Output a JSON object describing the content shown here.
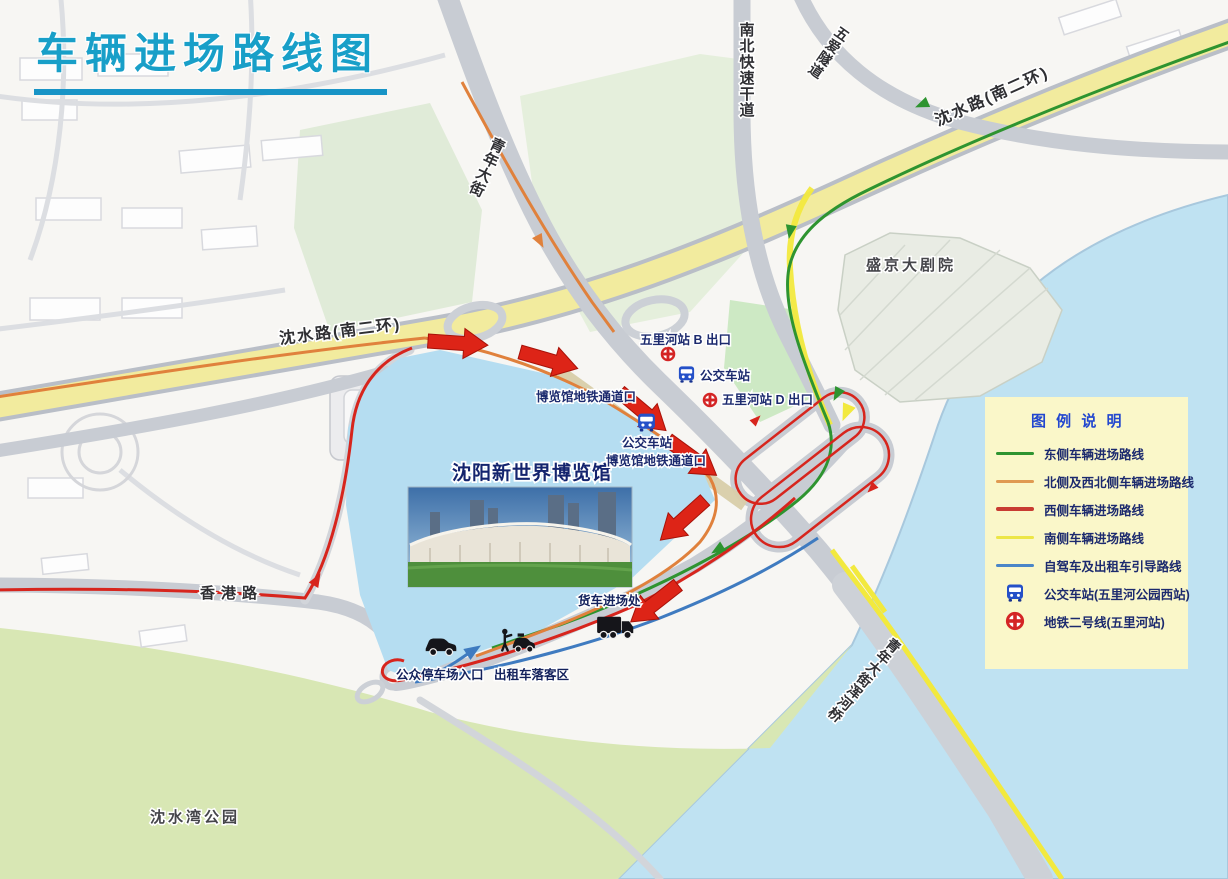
{
  "title": "车辆进场路线图",
  "map": {
    "roads": {
      "qingnian_street": "青年大街",
      "north_south_expressway": "南北快速干道",
      "wuai_tunnel": "五爱隧道",
      "shenshui_road_west": "沈水路(南二环)",
      "shenshui_road_east": "沈水路(南二环)",
      "hongkong_road": "香港路",
      "hunhe_bridge": "青年大街浑河桥"
    },
    "places": {
      "shengjing_theatre": "盛京大剧院",
      "shenshui_bay_park": "沈水湾公园",
      "expo_center": "沈阳新世界博览馆"
    },
    "stations": {
      "metro_exit_b": "五里河站 B 出口",
      "metro_exit_d": "五里河站 D 出口",
      "bus_station_north": "公交车站",
      "bus_station_west": "公交车站",
      "metro_passage_north": "博览馆地铁通道口",
      "metro_passage_east": "博览馆地铁通道口"
    },
    "facilities": {
      "truck_entrance": "货车进场处",
      "public_parking_entrance": "公众停车场入口",
      "taxi_dropoff": "出租车落客区"
    }
  },
  "legend": {
    "title": "图 例 说 明",
    "items": [
      {
        "label": "东侧车辆进场路线",
        "swatch": "line-green",
        "color": "#2e9430"
      },
      {
        "label": "北侧及西北侧车辆进场路线",
        "swatch": "line-orange",
        "color": "#e09a52"
      },
      {
        "label": "西侧车辆进场路线",
        "swatch": "line-red",
        "color": "#c83c32"
      },
      {
        "label": "南侧车辆进场路线",
        "swatch": "line-yellow",
        "color": "#ece646"
      },
      {
        "label": "自驾车及出租车引导路线",
        "swatch": "line-blue",
        "color": "#4a86c8"
      },
      {
        "label": "公交车站(五里河公园西站)",
        "swatch": "bus-icon"
      },
      {
        "label": "地铁二号线(五里河站)",
        "swatch": "metro-icon"
      }
    ]
  },
  "icons": {
    "bus_station": "bus-front-icon",
    "metro_line2": "metro-roundel-icon",
    "car": "car-side-icon",
    "taxi": "taxi-attendant-icon",
    "truck": "truck-side-icon"
  },
  "colors": {
    "title_teal": "#189fc8",
    "legend_bg": "#faf7c9",
    "legend_title_blue": "#2247cf",
    "water_blue": "#bfe2f2",
    "venue_blue": "#b5ddf1",
    "park_green": "#d8e7b4",
    "road_gray": "#c8ccd3",
    "road_yellow": "#f2eb9e",
    "route_east_green": "#2e9430",
    "route_north_orange": "#e0813c",
    "route_west_red": "#d7251d",
    "route_south_yellow": "#f2e93e",
    "route_guide_blue": "#3f7bc0",
    "arrow_red": "#dd2417",
    "label_navy": "#1c2a6e"
  }
}
